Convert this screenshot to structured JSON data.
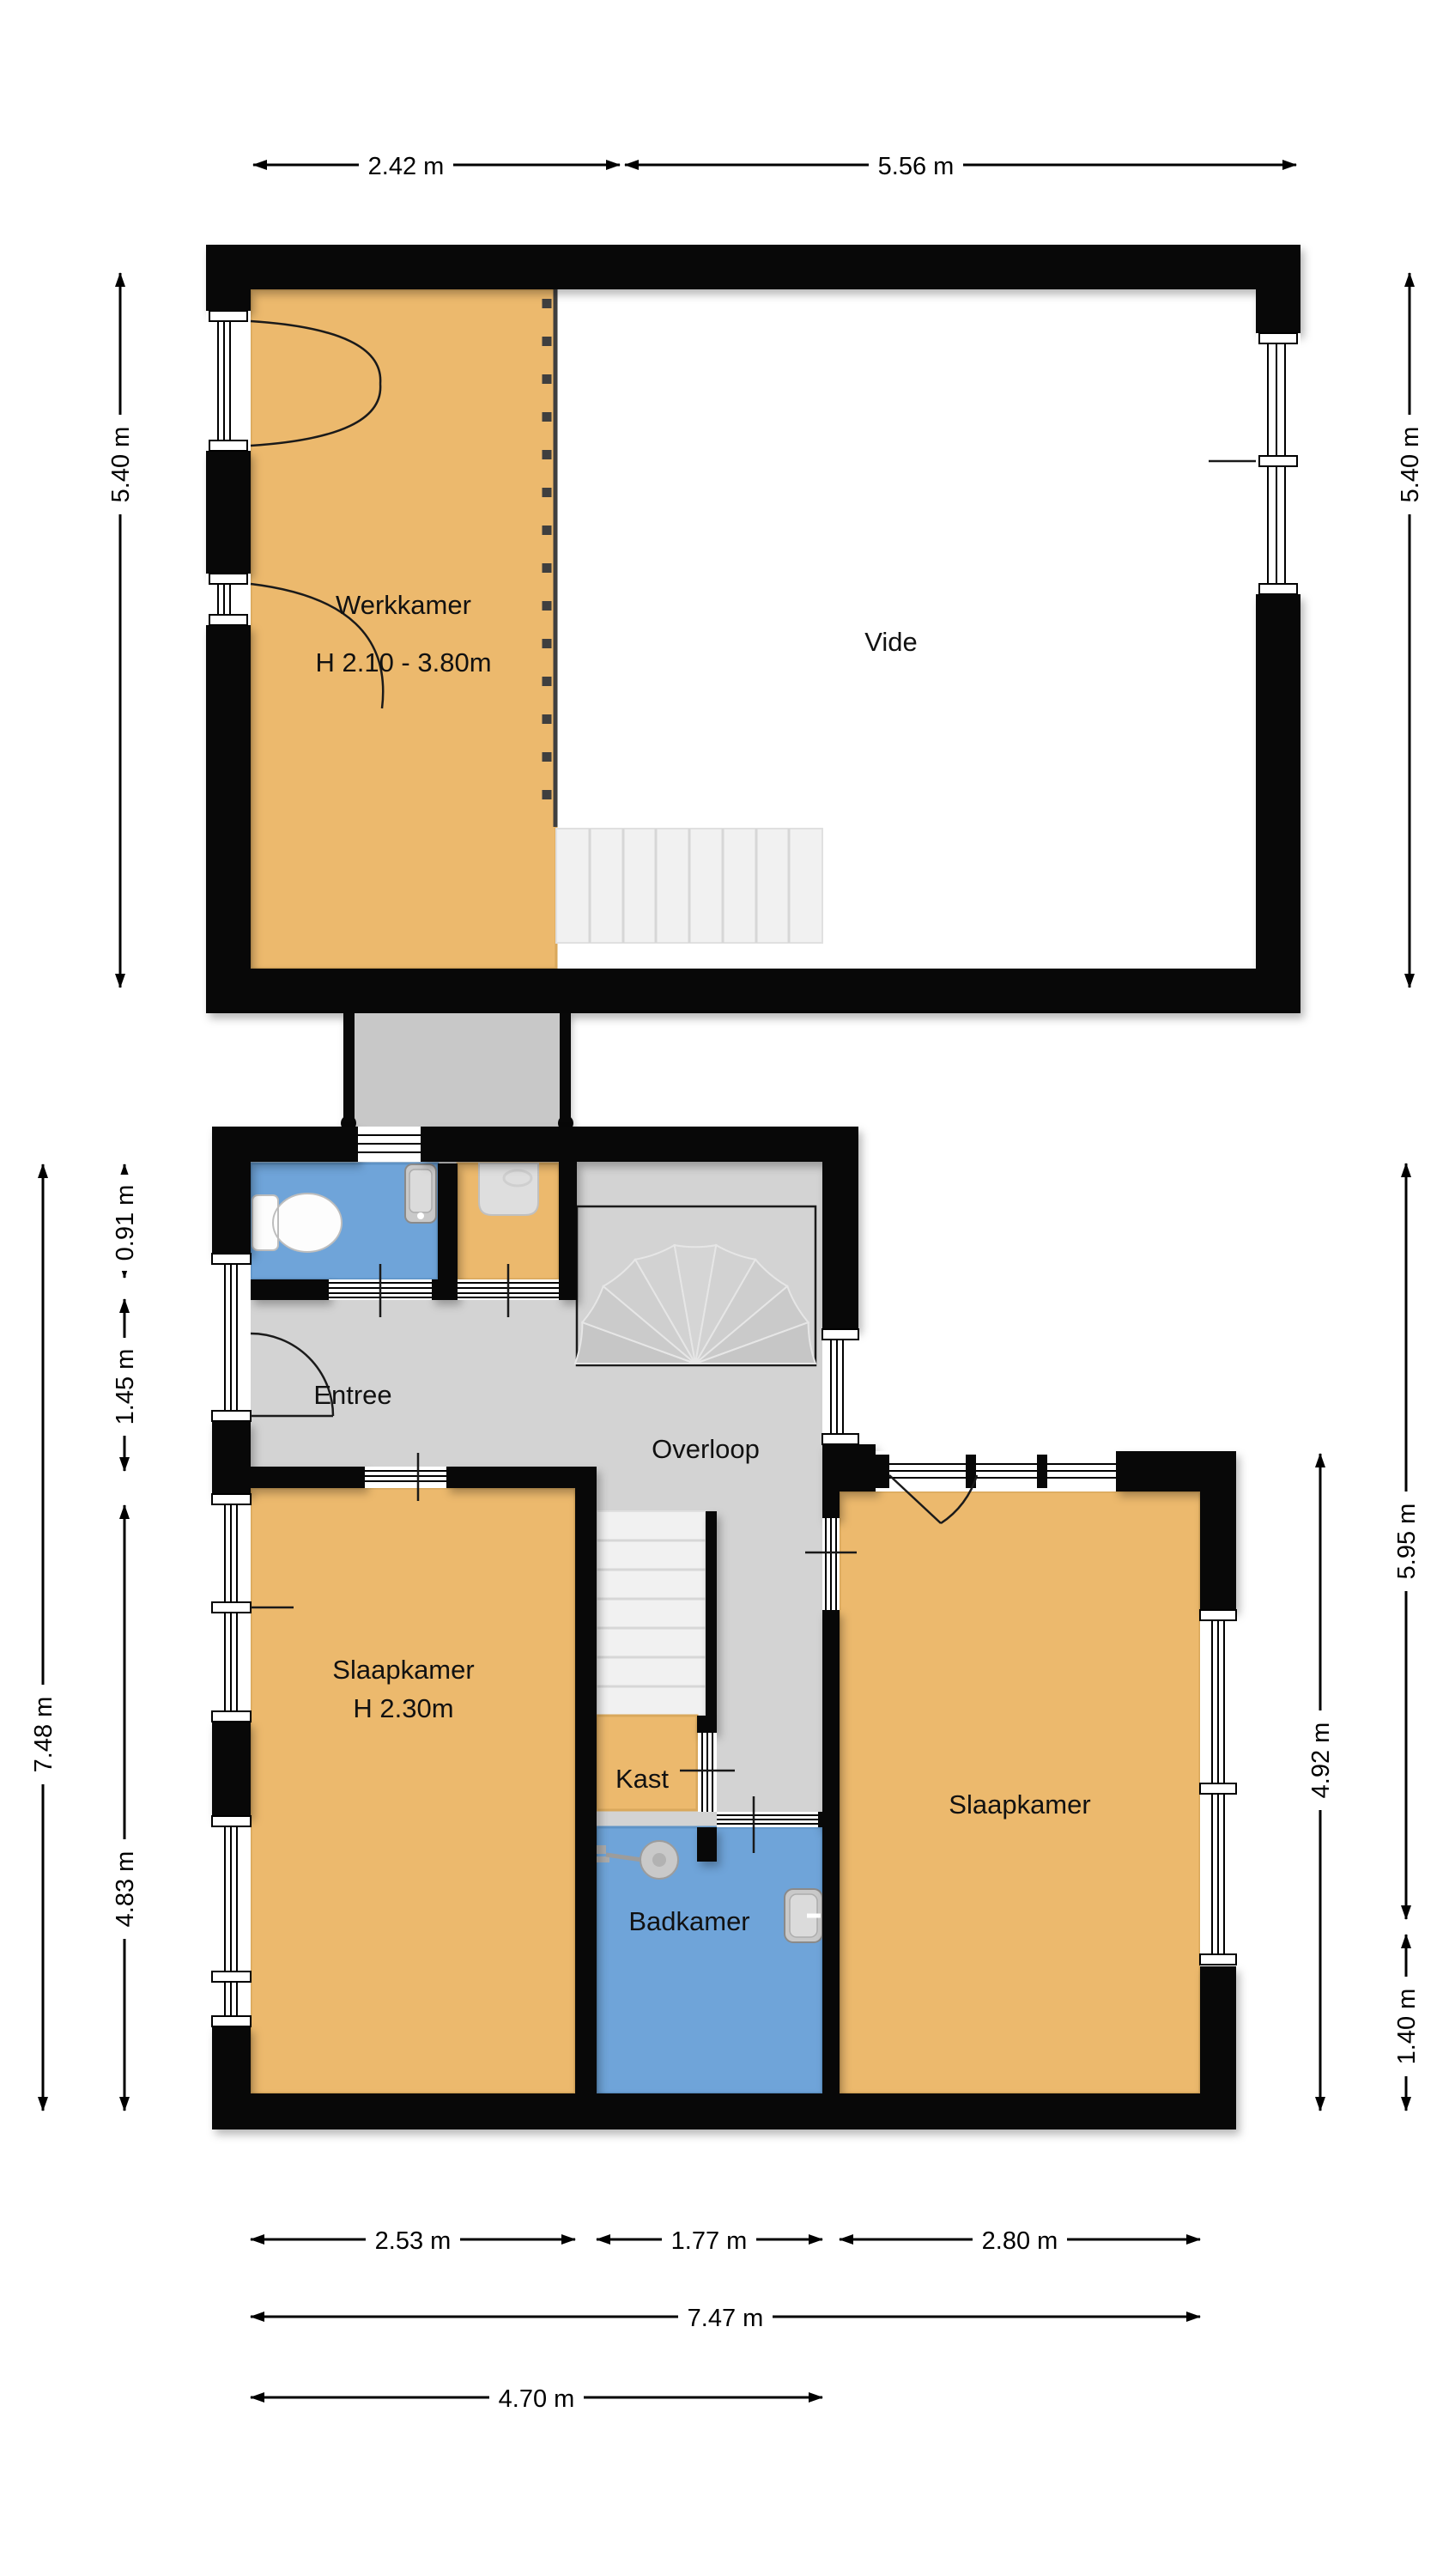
{
  "colors": {
    "wall": "#080808",
    "room_orange": "#ECB96D",
    "room_orange_border": "#D9A85C",
    "room_blue": "#6FA4D9",
    "floor_gray": "#D3D3D3",
    "connector_gray": "#C8C8C8",
    "stair_tread": "#F1F1F1",
    "dash_line": "#3F3F3F"
  },
  "upper_floor": {
    "werkkamer_label": "Werkkamer",
    "werkkamer_height": "H 2.10 - 3.80m",
    "vide_label": "Vide",
    "dim_top_left": "2.42 m",
    "dim_top_right": "5.56 m",
    "dim_side_left": "5.40 m",
    "dim_side_right": "5.40 m"
  },
  "lower_floor": {
    "entree_label": "Entree",
    "overloop_label": "Overloop",
    "kast_label": "Kast",
    "badkamer_label": "Badkamer",
    "slaapkamer_left_label": "Slaapkamer",
    "slaapkamer_left_height": "H 2.30m",
    "slaapkamer_right_label": "Slaapkamer",
    "dim_left_total": "7.48 m",
    "dim_left_wc": "0.91 m",
    "dim_left_entree": "1.45 m",
    "dim_left_bedroom": "4.83 m",
    "dim_right_total": "5.95 m",
    "dim_right_bedroom": "4.92 m",
    "dim_right_bottom": "1.40 m",
    "dim_bottom_left": "2.53 m",
    "dim_bottom_middle": "1.77 m",
    "dim_bottom_right": "2.80 m",
    "dim_bottom_total": "7.47 m",
    "dim_bottom_main": "4.70 m"
  }
}
